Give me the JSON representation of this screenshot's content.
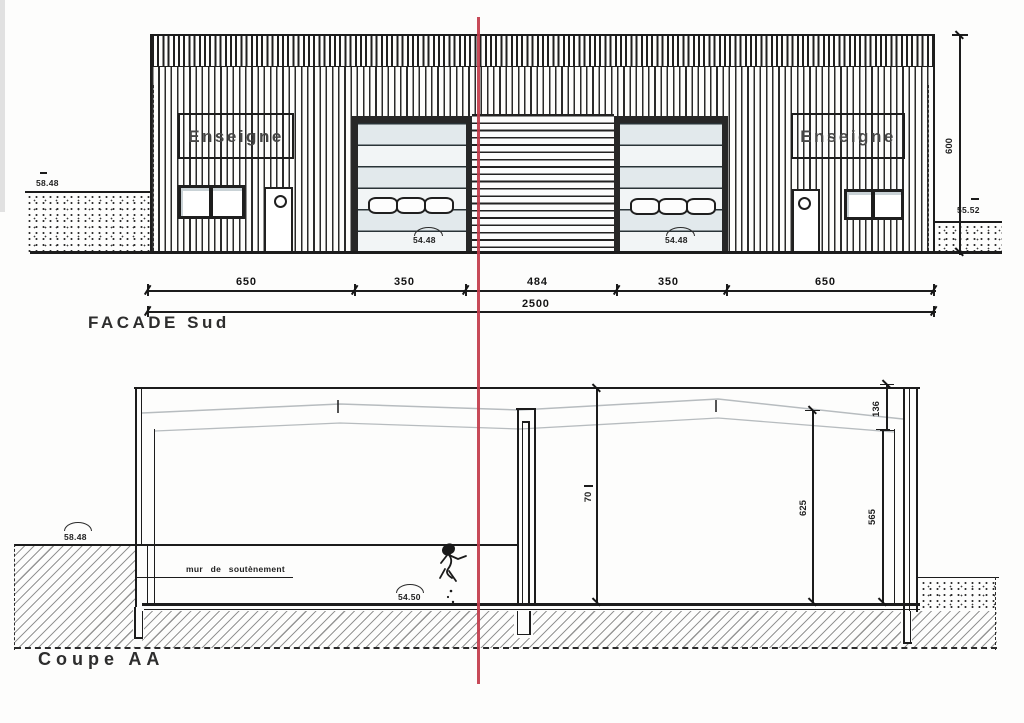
{
  "drawing": {
    "facade": {
      "title": "FACADE Sud",
      "sign_left": "Enseigne",
      "sign_right": "Enseigne",
      "ground_level_left": "58.48",
      "ground_level_right": "55.52",
      "door_sill_left": "54.48",
      "door_sill_right": "54.48",
      "height_dim": "600",
      "dim_segments": [
        "650",
        "350",
        "484",
        "350",
        "650"
      ],
      "dim_total": "2500"
    },
    "section": {
      "title": "Coupe AA",
      "ground_level_left": "58.48",
      "floor_level": "54.50",
      "retaining_wall_label": "mur de soutènement",
      "dim_clear_height": "70",
      "dim_eave_height": "625",
      "dim_wall_height": "565",
      "dim_roof_edge": "136"
    },
    "colors": {
      "line": "#1c1c1c",
      "red_cut_line": "#c23b4a",
      "glass": "#e3eaee",
      "roof_shade": "#b7bcbf"
    },
    "icons": {
      "person": "person-sketch",
      "level_marks": "level-arc"
    }
  }
}
